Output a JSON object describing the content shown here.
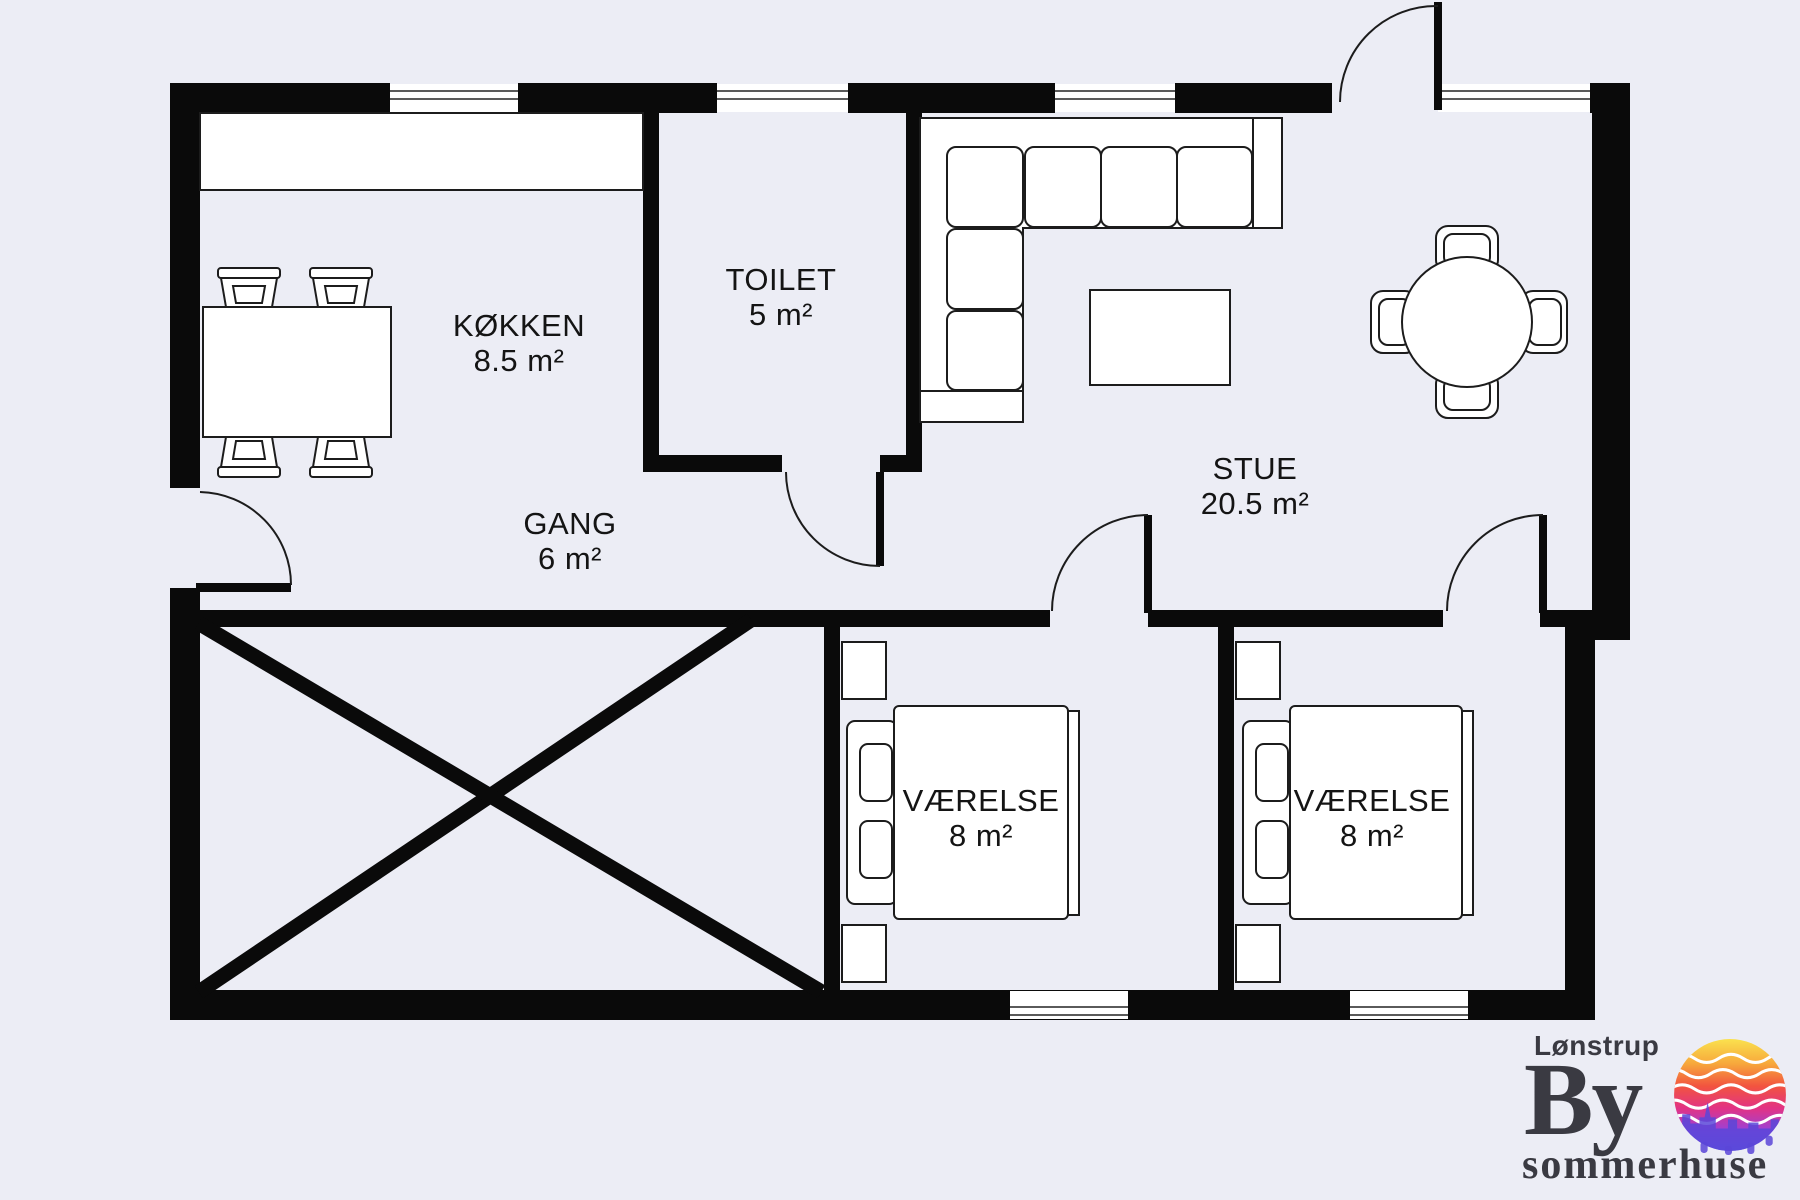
{
  "page": {
    "background_color": "#ECEDF5",
    "wall_color": "#0A0A0A",
    "line_color": "#1C1C1C",
    "furniture_fill": "#FFFFFF"
  },
  "plan": {
    "rooms": [
      {
        "name": "KØKKEN",
        "area": "8.5 m²"
      },
      {
        "name": "TOILET",
        "area": "5 m²"
      },
      {
        "name": "GANG",
        "area": "6 m²"
      },
      {
        "name": "STUE",
        "area": "20.5 m²"
      },
      {
        "name": "VÆRELSE",
        "area": "8 m²"
      },
      {
        "name": "VÆRELSE",
        "area": "8 m²"
      }
    ],
    "furniture_icons": [
      "kitchen-counter",
      "dining-table",
      "dining-chair",
      "corner-sofa",
      "coffee-table",
      "round-dining-table",
      "armchair",
      "double-bed",
      "pillow",
      "wardrobe",
      "window",
      "door-swing",
      "excluded-area-cross"
    ]
  },
  "logo": {
    "town": "Lønstrup",
    "main": "By",
    "sub": "sommerhuse",
    "text_color": "#3A3A42",
    "sun_gradient": {
      "top": "#FAE14E",
      "upper": "#F7A83C",
      "middle": "#F2543F",
      "lower": "#E23385",
      "deep": "#9A41D8",
      "bottom": "#5A5AE4"
    }
  }
}
